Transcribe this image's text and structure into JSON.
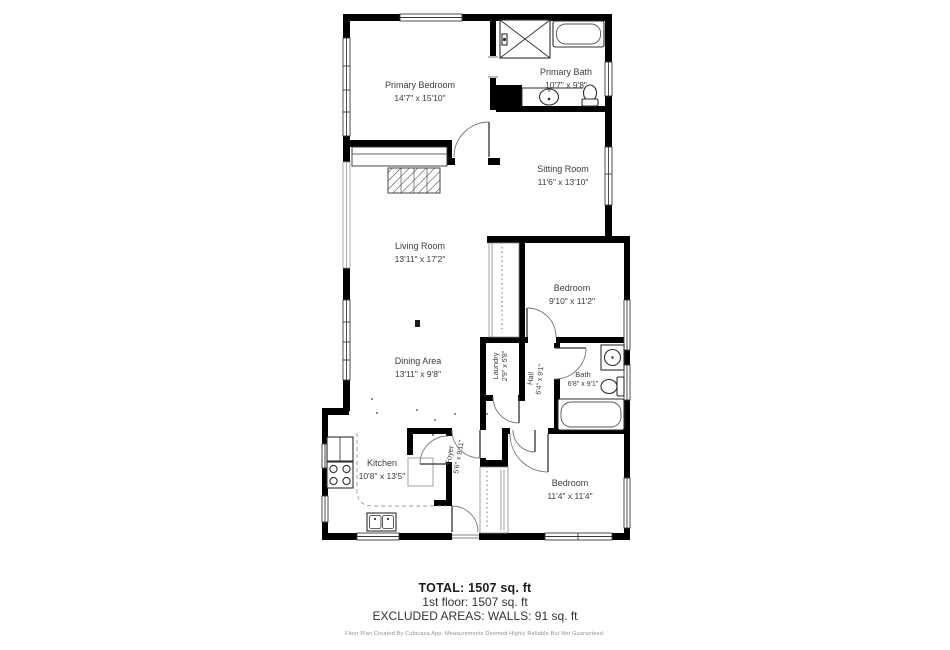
{
  "rooms": [
    {
      "id": "primary-bedroom",
      "name": "Primary Bedroom",
      "dims": "14'7\" x 15'10\""
    },
    {
      "id": "primary-bath",
      "name": "Primary Bath",
      "dims": "10'7\" x 9'8\""
    },
    {
      "id": "sitting-room",
      "name": "Sitting Room",
      "dims": "11'6\" x 13'10\""
    },
    {
      "id": "living-room",
      "name": "Living Room",
      "dims": "13'11\" x 17'2\""
    },
    {
      "id": "bedroom-middle",
      "name": "Bedroom",
      "dims": "9'10\" x 11'2\""
    },
    {
      "id": "dining-area",
      "name": "Dining Area",
      "dims": "13'11\" x 9'8\""
    },
    {
      "id": "laundry",
      "name": "Laundry",
      "dims": "2'9\" x 5'8\""
    },
    {
      "id": "hall",
      "name": "Hall",
      "dims": "6'4\" x 9'1\""
    },
    {
      "id": "bath",
      "name": "Bath",
      "dims": "6'8\" x 9'1\""
    },
    {
      "id": "kitchen",
      "name": "Kitchen",
      "dims": "10'8\" x 13'5\""
    },
    {
      "id": "foyer",
      "name": "Foyer",
      "dims": "5'6\" x 9'11\""
    },
    {
      "id": "bedroom-bottom",
      "name": "Bedroom",
      "dims": "11'4\" x 11'4\""
    }
  ],
  "summary": {
    "total": "TOTAL: 1507 sq. ft",
    "floor": "1st floor: 1507 sq. ft",
    "excluded": "EXCLUDED AREAS: WALLS: 91 sq. ft",
    "disclaimer": "Floor Plan Created By Cubicasa App. Measurements Deemed Highly Reliable But Not Guaranteed."
  },
  "colors": {
    "wall": "#000000",
    "fixture": "#2f2f2f",
    "label": "#3c3c3c",
    "background": "#ffffff"
  }
}
